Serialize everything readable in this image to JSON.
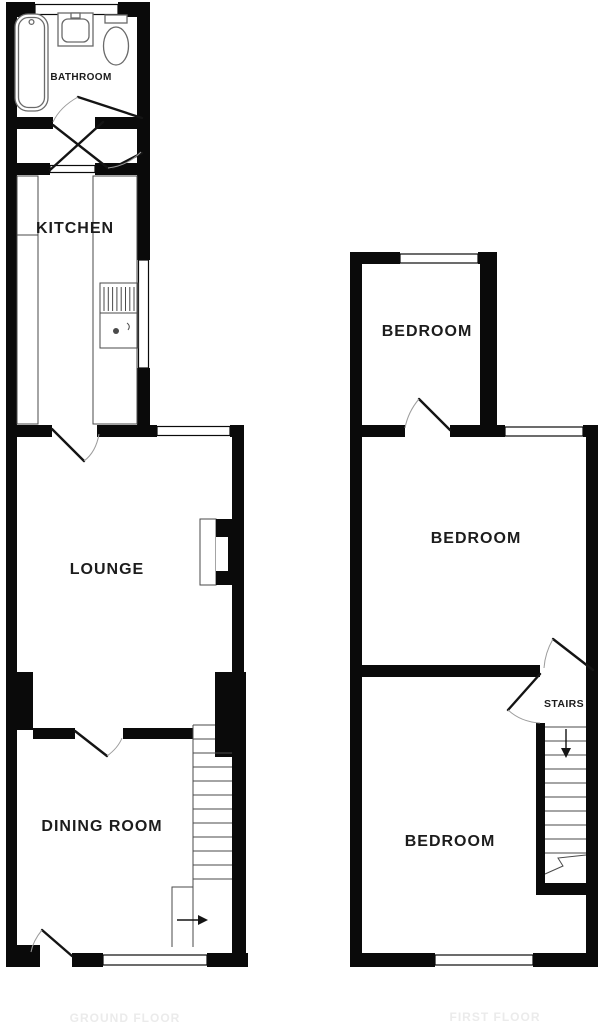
{
  "plans": {
    "ground_floor": {
      "floor_label": "GROUND FLOOR",
      "rooms": {
        "bathroom": "BATHROOM",
        "kitchen": "KITCHEN",
        "lounge": "LOUNGE",
        "dining_room": "DINING ROOM"
      }
    },
    "first_floor": {
      "floor_label": "FIRST FLOOR",
      "rooms": {
        "bedroom_front": "BEDROOM",
        "bedroom_middle": "BEDROOM",
        "stairs": "STAIRS",
        "bedroom_back": "BEDROOM"
      }
    }
  },
  "colors": {
    "wall": "#0a0a0a",
    "detail_line": "#4a4a4a",
    "door_arc": "#9c9c9c",
    "label": "#1c1c1c",
    "faint_label": "#ebebeb",
    "background": "#ffffff"
  }
}
